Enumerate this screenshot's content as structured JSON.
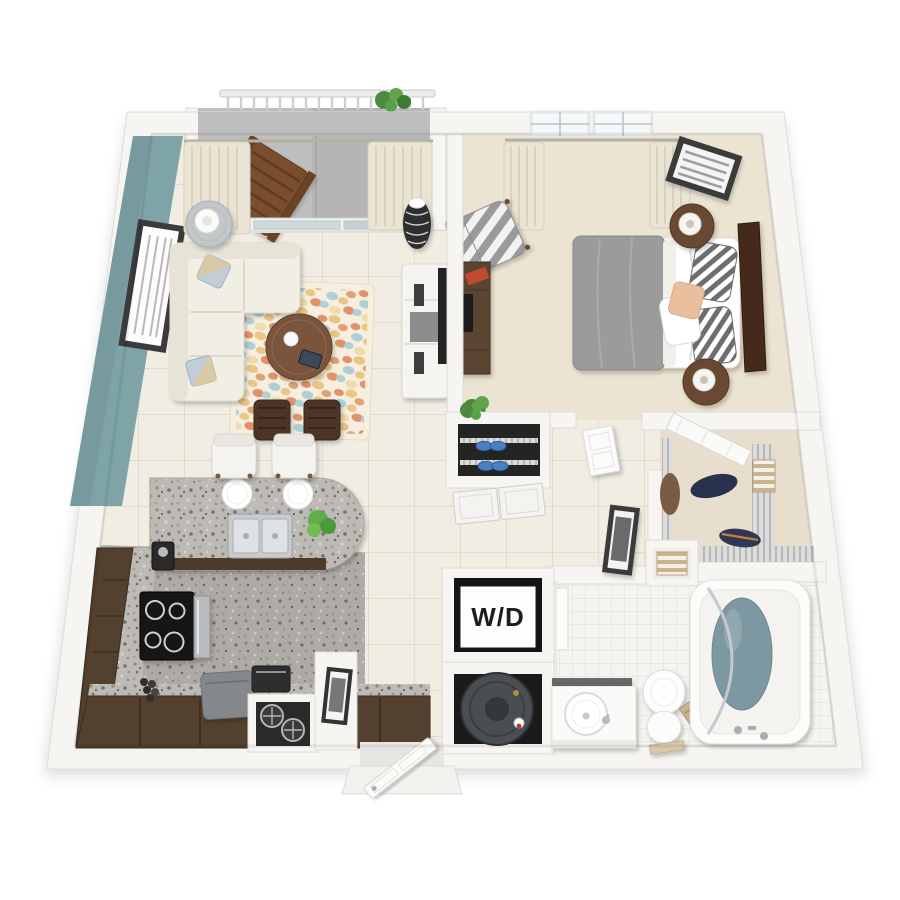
{
  "scene": {
    "title": "3D top-down floor plan render — one-bedroom apartment",
    "background": "#ffffff"
  },
  "labels": {
    "washer_dryer": "W/D"
  },
  "colors": {
    "accent_wall_teal": "#7EA4A8",
    "floor_tile_cream": "#F2EDE3",
    "tile_grout": "#E2DBCE",
    "carpet_beige": "#ECE4D2",
    "kitchen_floor_granite": "#AEABA6",
    "countertop_granite": "#BDBAB5",
    "cabinet_brown": "#54402F",
    "sofa_cream": "#F1EEE4",
    "coffee_table_brown": "#7A553C",
    "ottoman_wicker": "#4C3625",
    "rug_orange": "#E08A5F",
    "rug_gold": "#E9C27C",
    "rug_blue": "#A9CCD3",
    "bed_duvet_gray": "#9B9B9B",
    "headboard_brown": "#44291A",
    "bathtub_water": "#7E98A2",
    "water_heater_gray": "#4A4E52",
    "balcony_concrete": "#BEBEBE",
    "wall_white": "#F6F5F2",
    "closet_shoes_blue": "#4A7FC1",
    "towel_tan": "#C9B48F"
  },
  "rooms": [
    {
      "name": "balcony",
      "items": [
        "railing",
        "wooden-deck-chair",
        "potted-plant",
        "sliding-glass-door",
        "curtains"
      ]
    },
    {
      "name": "living-room",
      "items": [
        "teal-accent-wall",
        "framed-wall-art",
        "sectional-sofa",
        "accent-pillows",
        "side-table-with-lamp",
        "area-rug",
        "round-coffee-table",
        "wicker-ottomans",
        "tv-console",
        "flat-screen-tv",
        "decorative-vase"
      ]
    },
    {
      "name": "bedroom",
      "items": [
        "double-window",
        "curtains",
        "framed-wall-art",
        "bed",
        "gray-duvet",
        "striped-pillows",
        "peach-pillow",
        "headboard",
        "nightstands",
        "table-lamps",
        "striped-armchair",
        "dresser-with-tv",
        "potted-plant"
      ]
    },
    {
      "name": "kitchen",
      "items": [
        "granite-island",
        "double-sink",
        "faucet",
        "place-settings",
        "bar-stools",
        "potted-plant",
        "l-shaped-cabinets",
        "cooktop-range",
        "oven",
        "coffee-maker",
        "countertop-appliance",
        "gray-cart",
        "wire-basket-shelf",
        "pony-wall-with-art"
      ]
    },
    {
      "name": "entry",
      "items": [
        "front-door",
        "threshold",
        "stoop"
      ]
    },
    {
      "name": "hall-closet",
      "items": [
        "wire-shelves",
        "blue-shoes",
        "double-doors",
        "plant-on-half-wall"
      ]
    },
    {
      "name": "hallway",
      "items": [
        "leaning-framed-art",
        "bedroom-door"
      ]
    },
    {
      "name": "walk-in-closet",
      "items": [
        "wire-shelving",
        "hanging-clothes",
        "folded-towels",
        "closet-door",
        "towel-cubby"
      ]
    },
    {
      "name": "laundry-closet",
      "items": [
        "stacked-washer-dryer"
      ]
    },
    {
      "name": "utility-closet",
      "items": [
        "water-heater"
      ]
    },
    {
      "name": "bathroom",
      "items": [
        "vanity-with-vessel-sink",
        "mirror",
        "toilet",
        "towel-ladder",
        "bathtub",
        "shower-rod",
        "tile-floor",
        "bathroom-door"
      ]
    }
  ]
}
